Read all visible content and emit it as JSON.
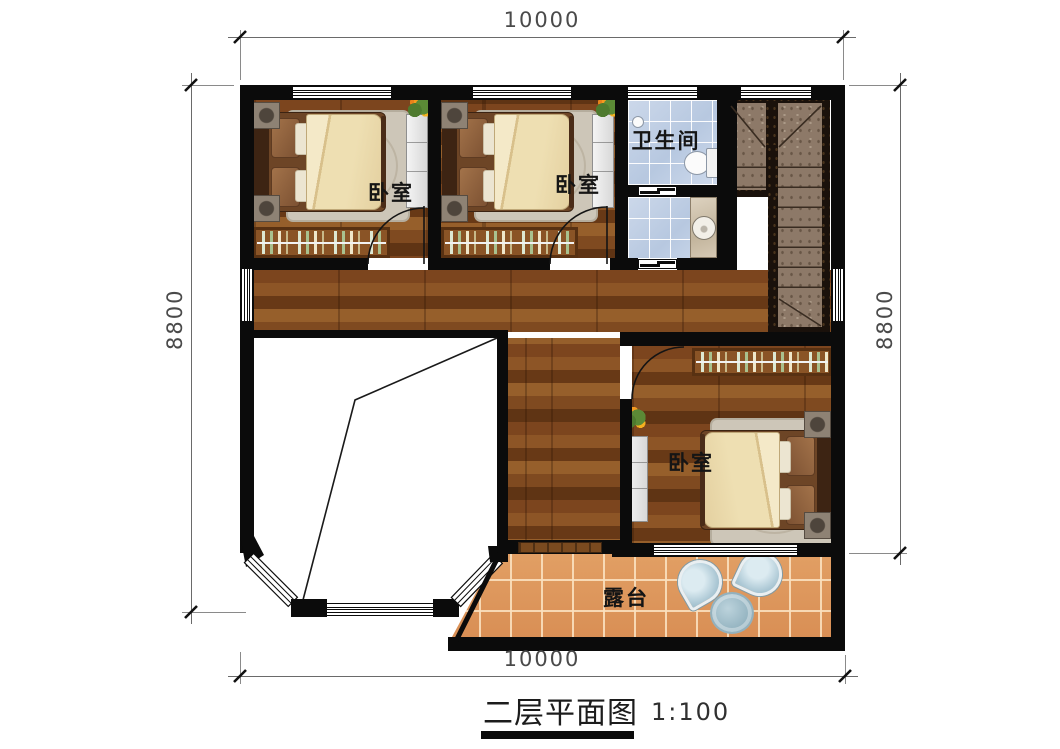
{
  "title": {
    "text": "二层平面图",
    "scale": "1:100"
  },
  "dimensions": {
    "top": "10000",
    "bottom": "10000",
    "left": "8800",
    "right": "8800"
  },
  "rooms": {
    "bedroom1": "卧室",
    "bedroom2": "卧室",
    "bedroom3": "卧室",
    "bathroom": "卫生间",
    "terrace": "露台"
  },
  "icons": {
    "bed": "bed-icon",
    "wardrobe": "wardrobe-icon",
    "rug": "rug-icon",
    "toilet": "toilet-icon",
    "sink": "sink-icon",
    "stairs": "stairs-icon",
    "chair": "chair-icon",
    "table": "table-icon",
    "flower": "plant-icon",
    "window": "window-icon",
    "door": "door-arc-icon"
  },
  "colors": {
    "wall": "#0b0b0b",
    "wood_floor": "#7c451e",
    "bathroom_tile": "#c3d1e6",
    "terrace_tile": "#de9c60",
    "stair_marble": "#8d7968",
    "bed_duvet": "#eedfb2",
    "dimension_text": "#4a4a4a"
  }
}
